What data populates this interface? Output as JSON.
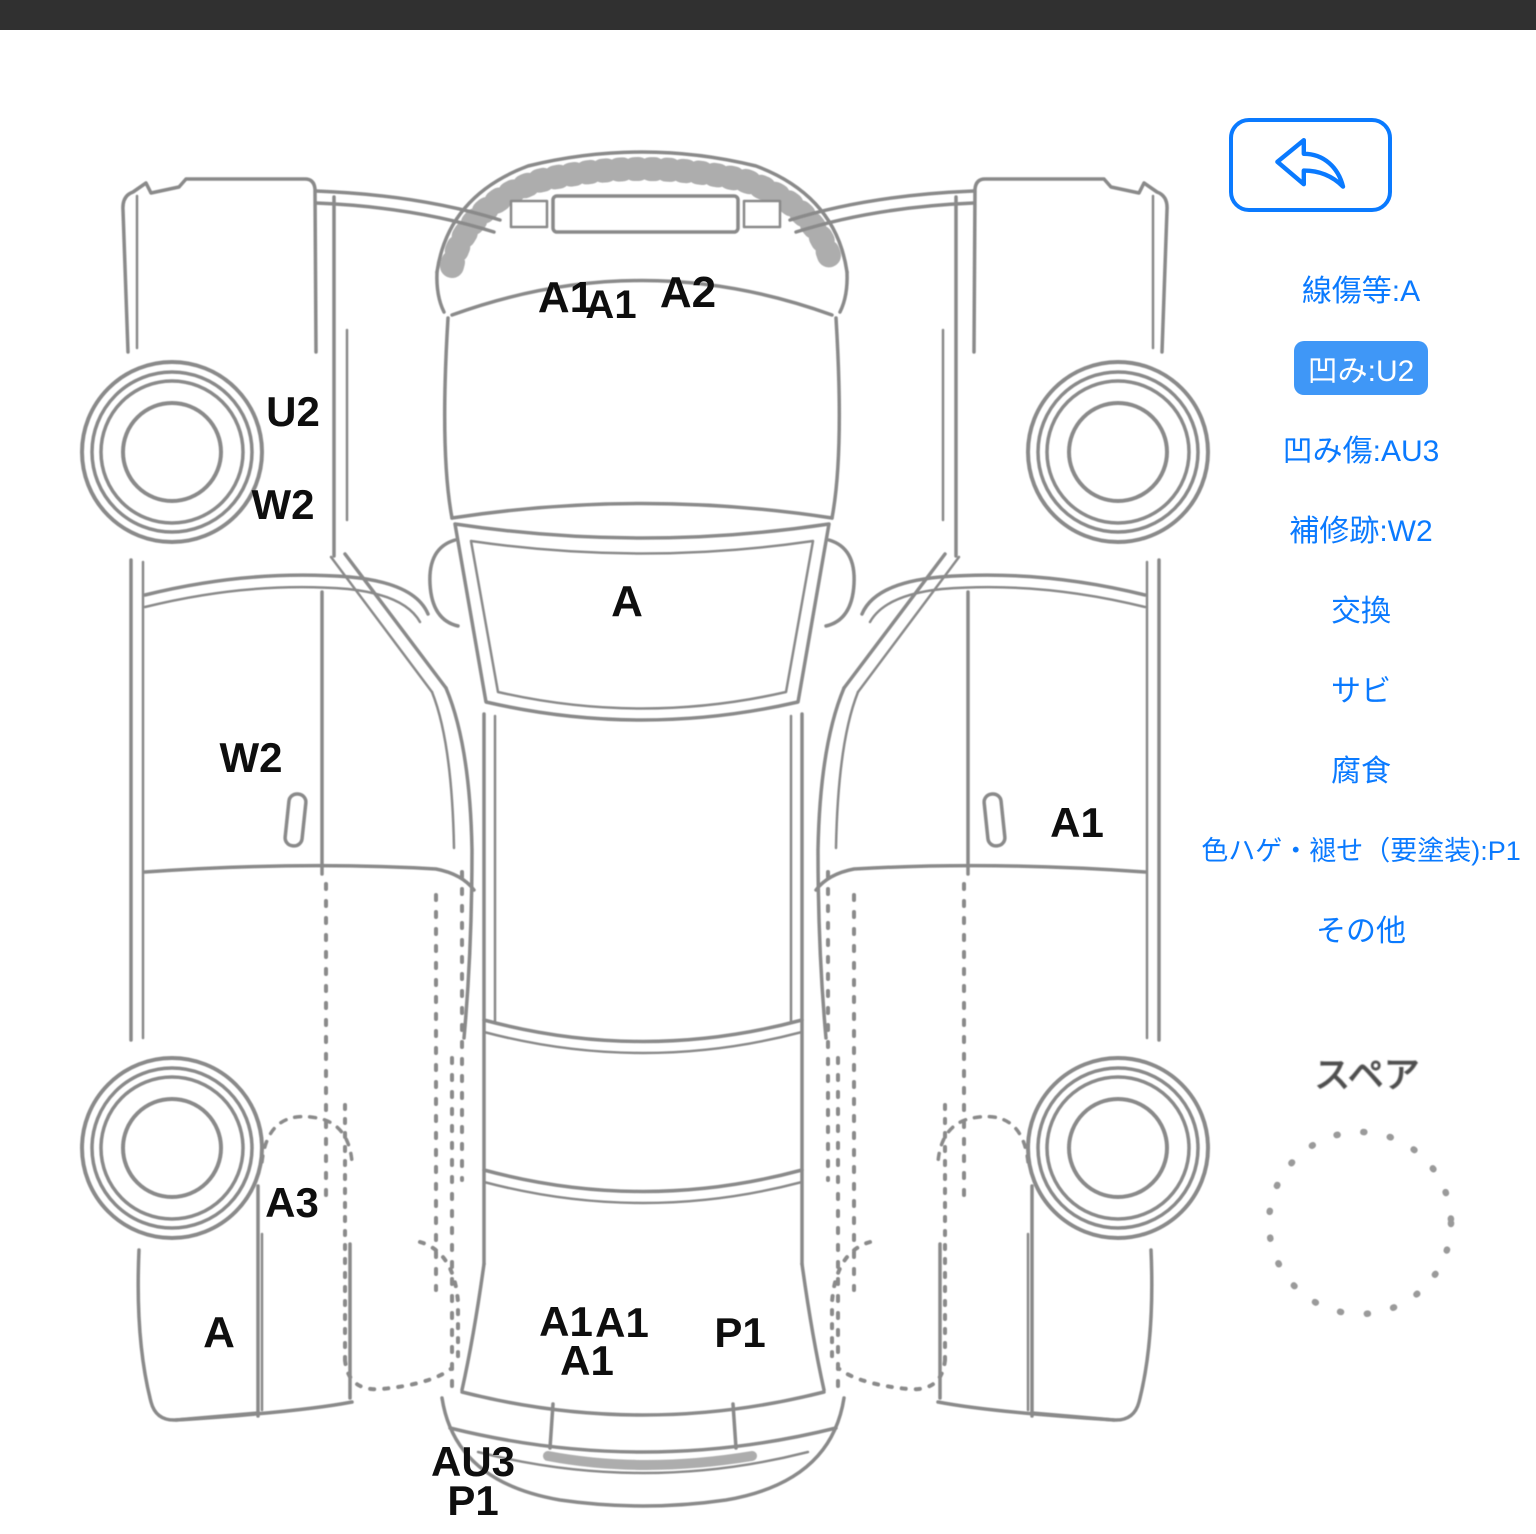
{
  "colors": {
    "accent": "#0A7AFF",
    "active_pill": "#3F97F7",
    "line_art": "#8A8A8A",
    "status_bar": "#303030",
    "label_text": "#0E0E0E"
  },
  "toolbar": {
    "back_button_icon": "reply-arrow-icon"
  },
  "legend": {
    "items": [
      {
        "label": "線傷等:A",
        "active": false
      },
      {
        "label": "凹み:U2",
        "active": true
      },
      {
        "label": "凹み傷:AU3",
        "active": false
      },
      {
        "label": "補修跡:W2",
        "active": false
      },
      {
        "label": "交換",
        "active": false
      },
      {
        "label": "サビ",
        "active": false
      },
      {
        "label": "腐食",
        "active": false
      },
      {
        "label": "色ハゲ・褪せ（要塗装):P1",
        "active": false
      },
      {
        "label": "その他",
        "active": false
      }
    ]
  },
  "diagram": {
    "damage_labels": [
      "A1",
      "A1",
      "A2",
      "U2",
      "W2",
      "A",
      "W2",
      "A1",
      "A3",
      "A",
      "A1",
      "A1",
      "A1",
      "P1",
      "AU3",
      "P1"
    ],
    "spare_label": "スペア"
  }
}
